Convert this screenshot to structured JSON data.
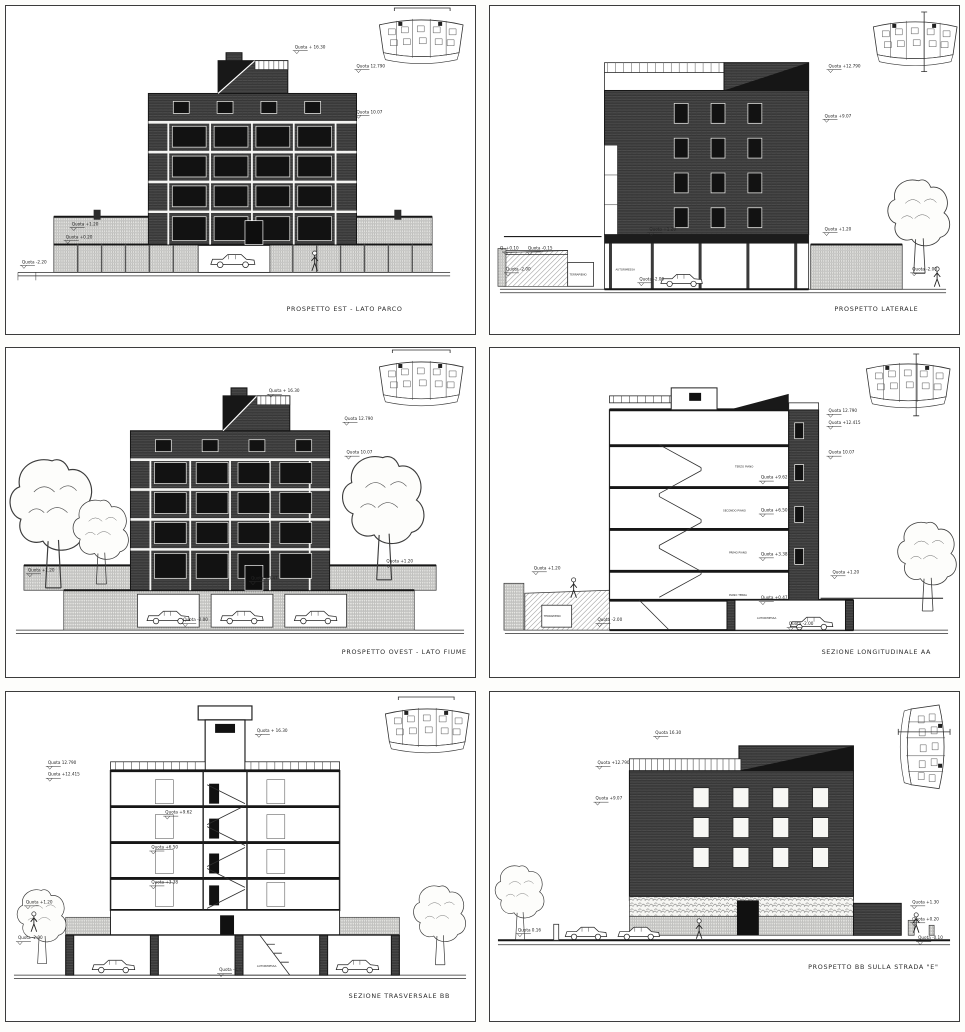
{
  "sheet": {
    "type": "architectural-drawing-sheet",
    "paper_color": "#ffffff",
    "ink_color": "#1f1f1f",
    "facade_hatch_color": "#4c4c4c",
    "light_hatch_color": "#8f8f8c"
  },
  "panels": [
    {
      "caption": "PROSPETTO EST - LATO PARCO",
      "annotations": [
        {
          "text": "Quota + 16.30"
        },
        {
          "text": "Quota 12.790"
        },
        {
          "text": "Quota 10.07"
        },
        {
          "text": "Quota +1.20"
        },
        {
          "text": "Quota +0.20"
        },
        {
          "text": "Quota -2.20"
        }
      ]
    },
    {
      "caption": "PROSPETTO LATERALE",
      "annotations": [
        {
          "text": "Quota +12.790"
        },
        {
          "text": "Quota +9.07"
        },
        {
          "text": "Quota +1.20"
        },
        {
          "text": "Quota +1.20"
        },
        {
          "text": "Q. +0.10"
        },
        {
          "text": "Quota -0.15"
        },
        {
          "text": "Quota -2.00"
        },
        {
          "text": "TERRAPIENO"
        },
        {
          "text": "AUTORIMESSA"
        },
        {
          "text": "Quota -2.00"
        },
        {
          "text": "Quota -2.00"
        }
      ]
    },
    {
      "caption": "PROSPETTO OVEST - LATO FIUME",
      "annotations": [
        {
          "text": "Quota + 16.30"
        },
        {
          "text": "Quota 12.790"
        },
        {
          "text": "Quota 10.07"
        },
        {
          "text": "Quota +1.20"
        },
        {
          "text": "Quota +1.20"
        },
        {
          "text": "Quota +0.47"
        },
        {
          "text": "Quota -2.00"
        }
      ]
    },
    {
      "caption": "SEZIONE LONGITUDINALE AA",
      "annotations": [
        {
          "text": "Quota 12.790"
        },
        {
          "text": "Quota +12.415"
        },
        {
          "text": "Quota 10.07"
        },
        {
          "text": "TERZO PIANO"
        },
        {
          "text": "Quota +9.62"
        },
        {
          "text": "SECONDO PIANO"
        },
        {
          "text": "Quota +6.50"
        },
        {
          "text": "PRIMO PIANO"
        },
        {
          "text": "Quota +3.38"
        },
        {
          "text": "PIANO TERRA"
        },
        {
          "text": "Quota +0.47"
        },
        {
          "text": "Quota +1.20"
        },
        {
          "text": "Quota +1.20"
        },
        {
          "text": "TERRAPIENO"
        },
        {
          "text": "Quota -2.00"
        },
        {
          "text": "AUTORIMESSA"
        },
        {
          "text": "Quota -2.00"
        }
      ]
    },
    {
      "caption": "SEZIONE TRASVERSALE BB",
      "annotations": [
        {
          "text": "Quota + 16.30"
        },
        {
          "text": "Quota 12.790"
        },
        {
          "text": "Quota +12.415"
        },
        {
          "text": "Quota +9.62"
        },
        {
          "text": "Quota +6.50"
        },
        {
          "text": "Quota +3.38"
        },
        {
          "text": "Quota +1.20"
        },
        {
          "text": "Quota -2.00"
        },
        {
          "text": "AUTORIMESSA"
        },
        {
          "text": "Quota -2.44"
        }
      ]
    },
    {
      "caption": "PROSPETTO BB SULLA STRADA \"E\"",
      "annotations": [
        {
          "text": "Quota 16.30"
        },
        {
          "text": "Quota +12.790"
        },
        {
          "text": "Quota +9.07"
        },
        {
          "text": "Quota 0.16"
        },
        {
          "text": "Quota +1.30"
        },
        {
          "text": "Quota +0.20"
        },
        {
          "text": "Quota -0.10"
        }
      ]
    }
  ]
}
